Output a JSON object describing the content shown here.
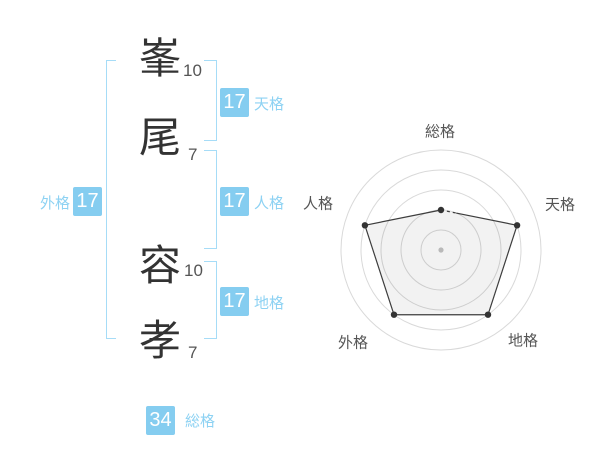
{
  "name": {
    "characters": [
      {
        "char": "峯",
        "strokes": "10"
      },
      {
        "char": "尾",
        "strokes": "7"
      },
      {
        "char": "容",
        "strokes": "10"
      },
      {
        "char": "孝",
        "strokes": "7"
      }
    ]
  },
  "badges": {
    "tenkaku": {
      "value": "17",
      "label": "天格"
    },
    "jinkaku": {
      "value": "17",
      "label": "人格"
    },
    "chikaku": {
      "value": "17",
      "label": "地格"
    },
    "gaikaku": {
      "value": "17",
      "label": "外格"
    },
    "soukaku": {
      "value": "34",
      "label": "総格"
    }
  },
  "colors": {
    "badge_blue": "#85cdf0",
    "label_blue": "#8dd2f3",
    "bracket_blue": "#a6dcf7",
    "kanji_gray": "#333333",
    "ring_gray": "#d9d9d9",
    "line_dark": "#3d3d3d",
    "center_dot_gray": "#b9b9b9"
  },
  "chart_data": {
    "type": "radar",
    "categories": [
      "総格",
      "天格",
      "地格",
      "外格",
      "人格"
    ],
    "values": [
      2,
      4,
      4,
      4,
      4
    ],
    "max": 5,
    "rings": 5,
    "grid_shape": "circular",
    "spokes": false,
    "legend": "none",
    "center_marker": true
  }
}
